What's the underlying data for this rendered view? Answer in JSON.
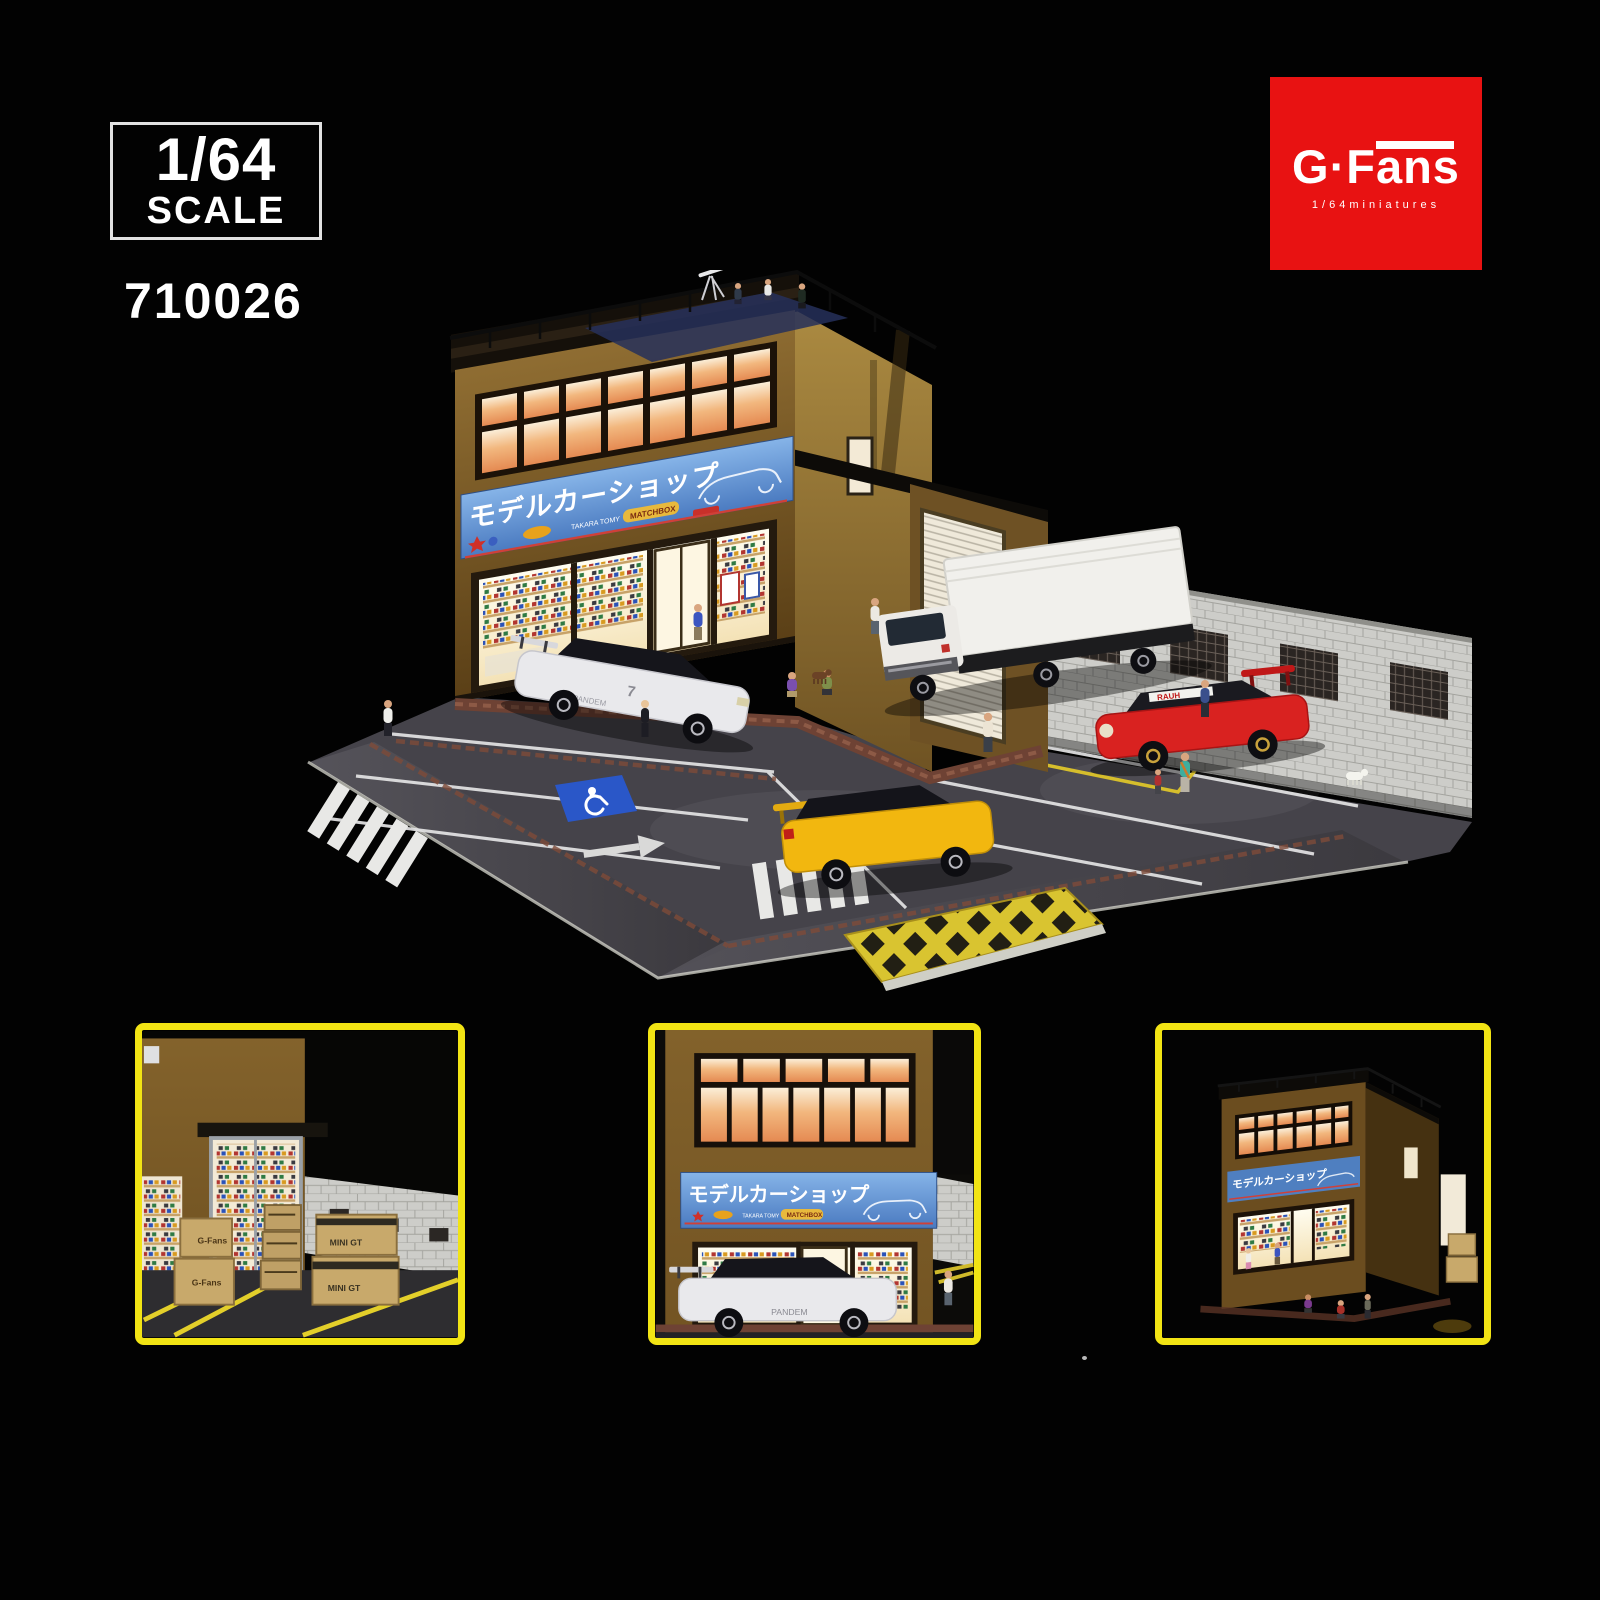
{
  "header": {
    "scale_badge": {
      "value": "1/64",
      "word": "SCALE"
    },
    "product_code": "710026",
    "logo": {
      "text": "G·Fans",
      "subtext": "1/64miniatures",
      "caption": "G FANS-MODELS",
      "bg_color": "#e81212"
    }
  },
  "diorama": {
    "shop_sign": {
      "text": "モデルカーショップ",
      "brand1": "TAKARA TOMY",
      "brand2": "MATCHBOX",
      "bg_color": "#5c93d6"
    },
    "cars": {
      "gtr_label": "PANDEM",
      "gtr_number": "7",
      "rwb_banner": "RAUH"
    },
    "colors": {
      "front_wall": "#8a6830",
      "side_wall": "#a9883f",
      "asphalt": "#45434a",
      "hatch_yellow": "#d9c430",
      "handicap_blue": "#2a57c8",
      "thumb_border": "#f2e414",
      "gtr_white": "#e9e9ec",
      "evo_yellow": "#f2b70f",
      "rwb_red": "#d92220"
    }
  },
  "thumbnails": {
    "side_entrance": {
      "exit_sign": "EXIT",
      "box_label_gfans": "G-Fans",
      "box_label_minigt": "MINI GT"
    },
    "storefront": {
      "car_label": "PANDEM"
    },
    "night_view": {}
  }
}
